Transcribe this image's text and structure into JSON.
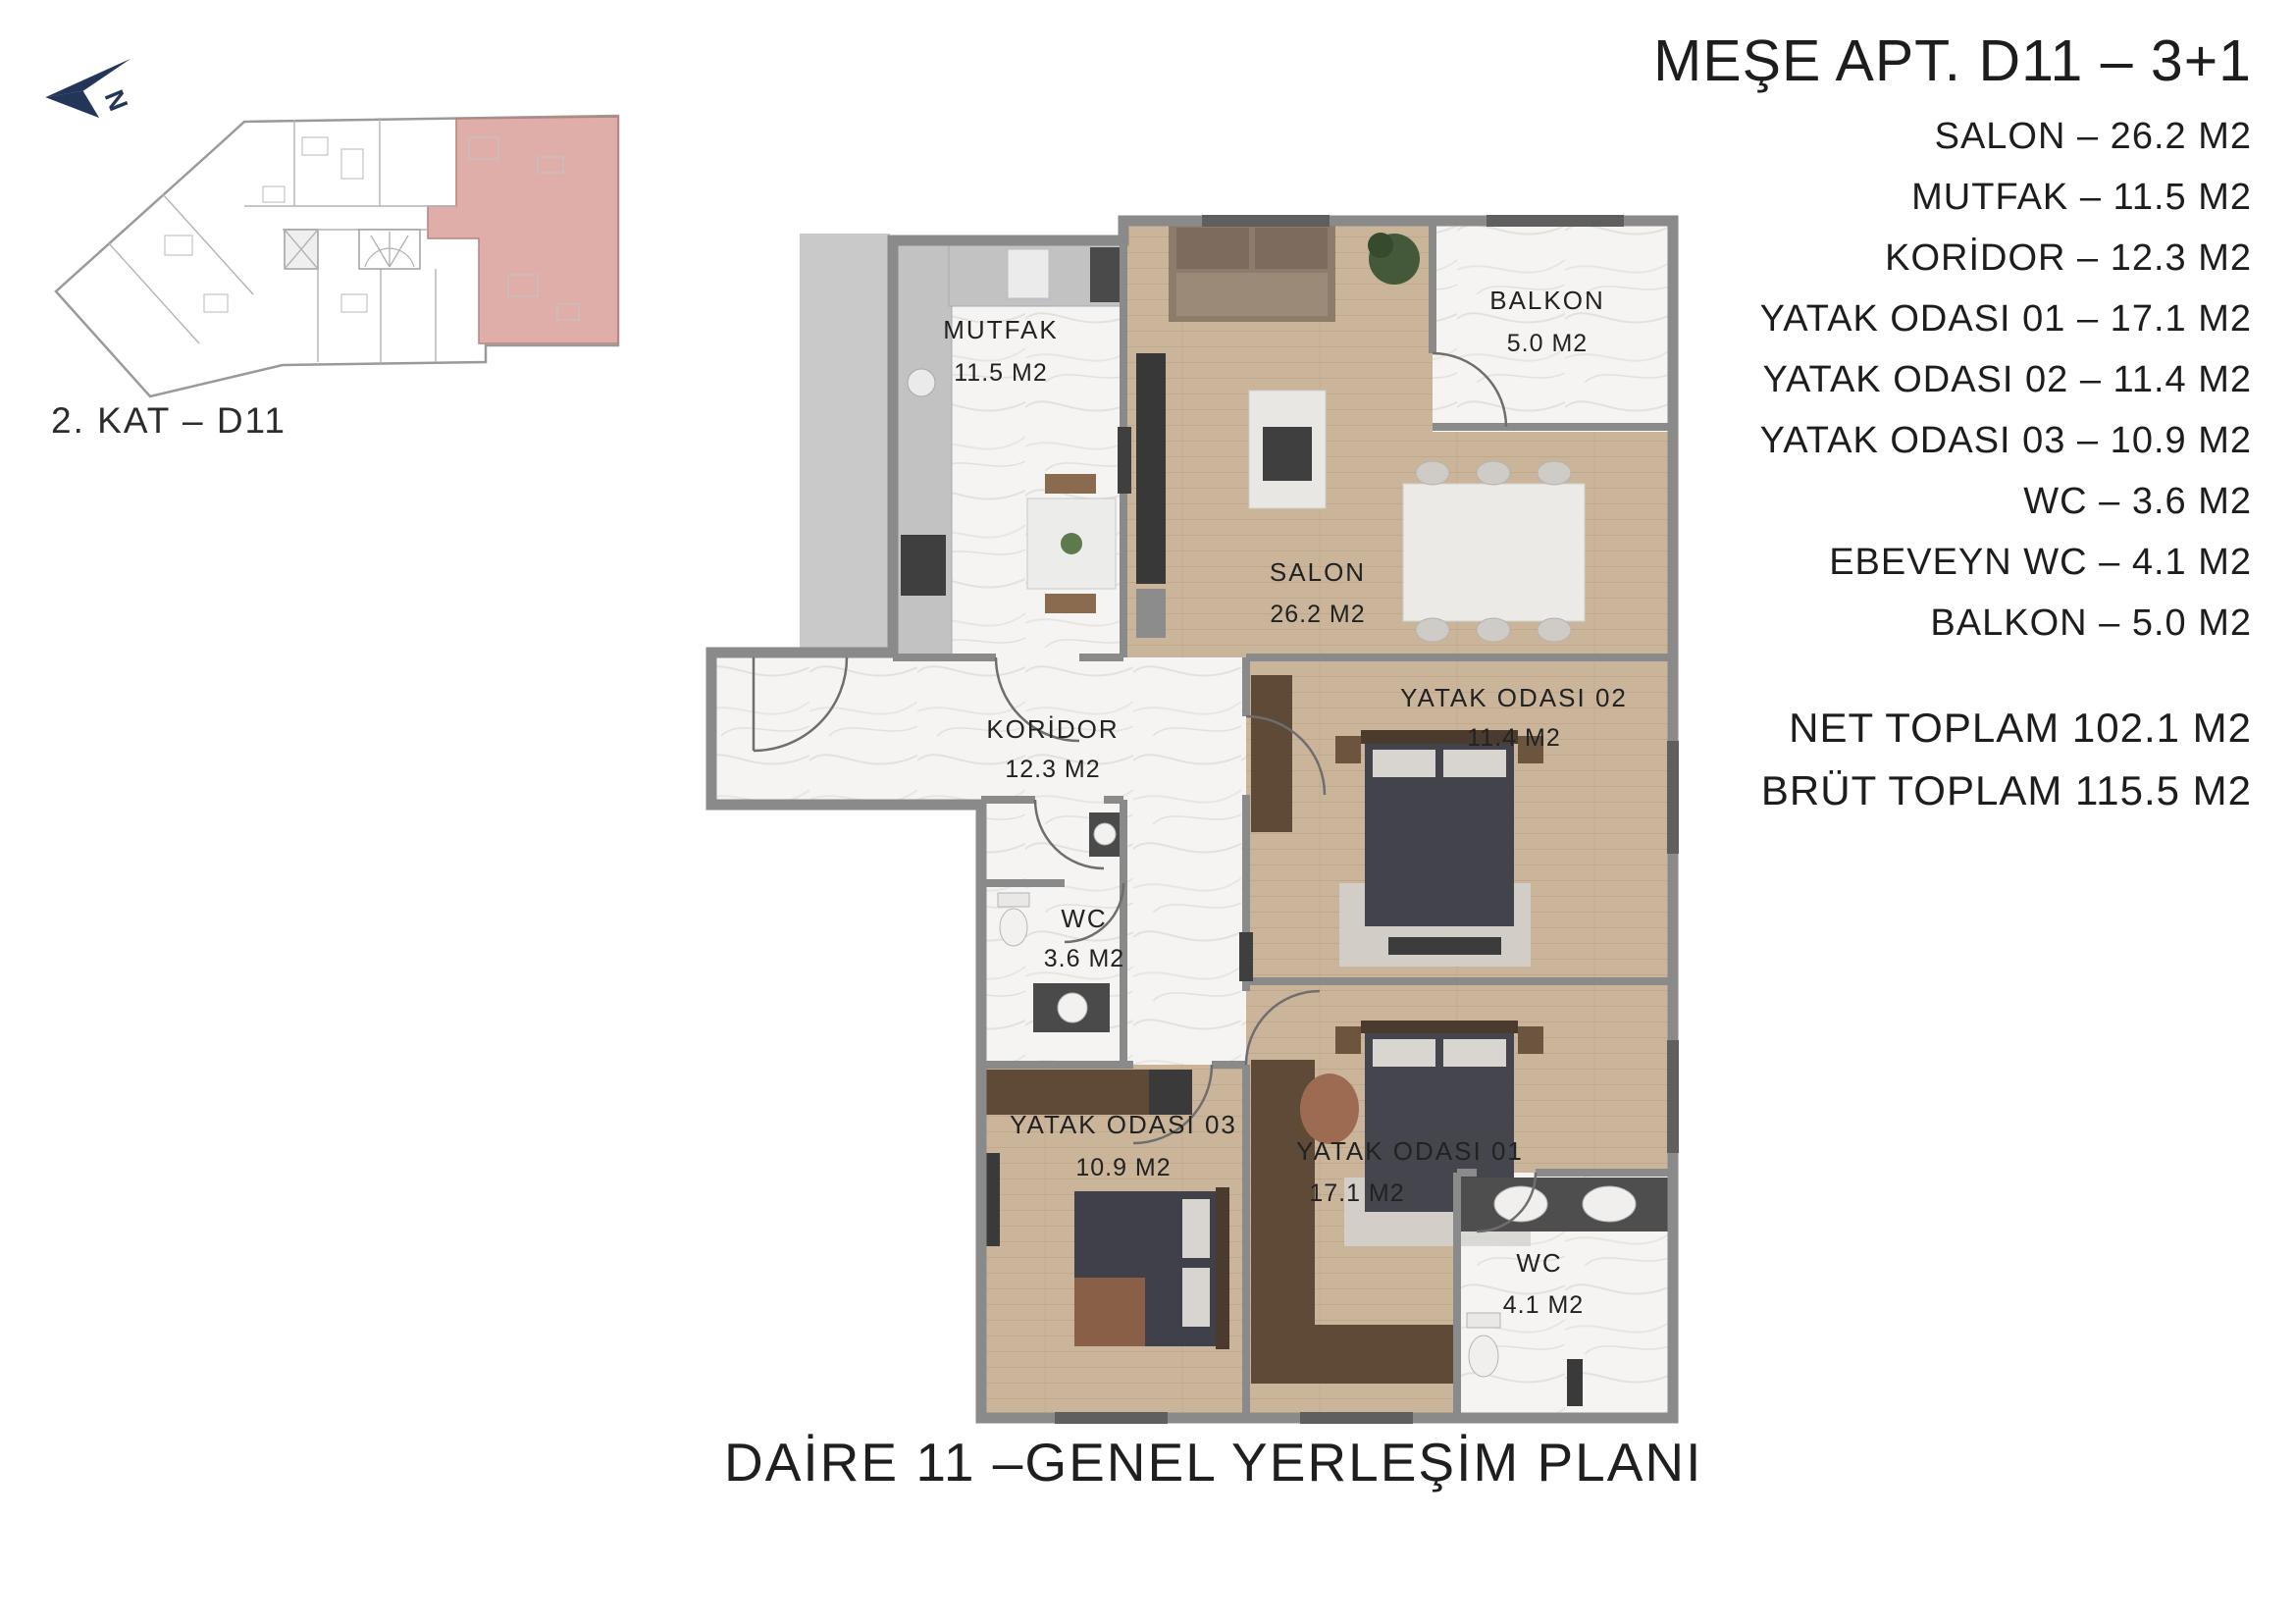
{
  "page": {
    "caption": "DAİRE 11 –GENEL YERLEŞİM PLANI"
  },
  "overview": {
    "floor_label": "2. KAT – D11",
    "compass_letter": "N",
    "compass_color": "#24355a",
    "highlight_color": "#d9a09a"
  },
  "info_panel": {
    "title": "MEŞE APT. D11 – 3+1",
    "rooms": [
      "SALON – 26.2 M2",
      "MUTFAK – 11.5 M2",
      "KORİDOR – 12.3 M2",
      "YATAK ODASI 01 – 17.1 M2",
      "YATAK ODASI 02 – 11.4 M2",
      "YATAK ODASI 03 – 10.9 M2",
      "WC – 3.6 M2",
      "EBEVEYN WC – 4.1 M2",
      "BALKON – 5.0 M2"
    ],
    "net_total": "NET TOPLAM 102.1 M2",
    "gross_total": "BRÜT TOPLAM 115.5 M2"
  },
  "floor_plan": {
    "rooms": [
      {
        "name": "MUTFAK",
        "area": "11.5 M2"
      },
      {
        "name": "SALON",
        "area": "26.2 M2"
      },
      {
        "name": "BALKON",
        "area": "5.0 M2"
      },
      {
        "name": "KORİDOR",
        "area": "12.3 M2"
      },
      {
        "name": "WC",
        "area": "3.6 M2"
      },
      {
        "name": "YATAK ODASI 02",
        "area": "11.4 M2"
      },
      {
        "name": "YATAK ODASI 03",
        "area": "10.9 M2"
      },
      {
        "name": "YATAK ODASI 01",
        "area": "17.1 M2"
      },
      {
        "name": "WC",
        "area": "4.1 M2"
      }
    ],
    "colors": {
      "wood": "#cbb59a",
      "marble": "#f5f4f2",
      "wall": "#8a8a8a",
      "dark": "#3f3f3f",
      "wardrobe": "#5e4a36",
      "text": "#222222"
    }
  }
}
